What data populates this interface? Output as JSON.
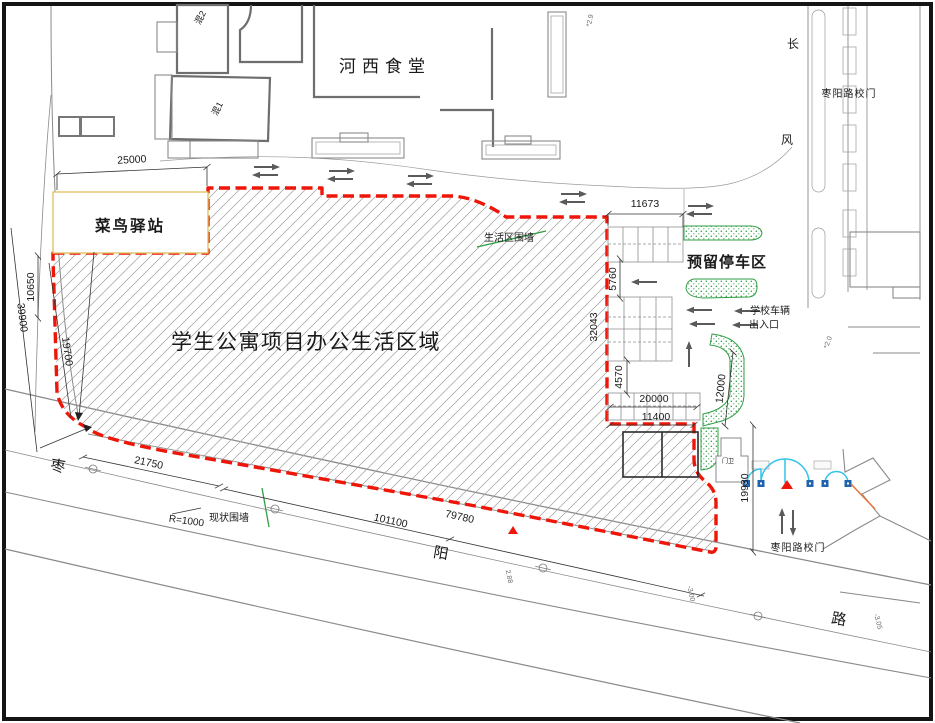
{
  "labels": {
    "hexi_canteen": "河西食堂",
    "cainiao_station": "菜鸟驿站",
    "main_area": "学生公寓项目办公生活区域",
    "reserved_parking": "预留停车区",
    "living_area_wall": "生活区围墙",
    "existing_wall": "现状围墙",
    "school_vehicle_line1": "学校车辆",
    "school_vehicle_line2": "出入口",
    "gate_north": "枣阳路校门",
    "gate_south": "枣阳路校门",
    "guard_house": "门卫",
    "building_hun1": "混1",
    "building_hun2": "混2",
    "road_char_zao": "枣",
    "road_char_yang": "阳",
    "road_char_lu": "路",
    "side_road_char_chang": "长",
    "side_road_char_feng": "风",
    "radius_note": "R=1000"
  },
  "dimensions": {
    "d25000": "25000",
    "d10650": "10650",
    "d39900": "39900",
    "d19700": "19700",
    "d21750": "21750",
    "d101100": "101100",
    "d79780": "79780",
    "d11673": "11673",
    "d5760": "5760",
    "d32043": "32043",
    "d4570": "4570",
    "d20000": "20000",
    "d11400": "11400",
    "d12000": "12000",
    "d19930": "19930"
  },
  "elevations": {
    "top": "*2.9",
    "right": "*2.0",
    "road_mid": "2.88",
    "road_right1": "-3.00",
    "road_right2": "-3.05"
  },
  "colors": {
    "boundary_red": "#ee1509",
    "highlight_red": "#f01510",
    "landscape_green": "#2f9e44",
    "gate_cyan": "#35c3e8",
    "gate_post_blue": "#1e63ad",
    "ramp_orange": "#e07a3f",
    "station_border_yellow": "#dfc05c",
    "watermark_gray": "#c9c9c9"
  }
}
